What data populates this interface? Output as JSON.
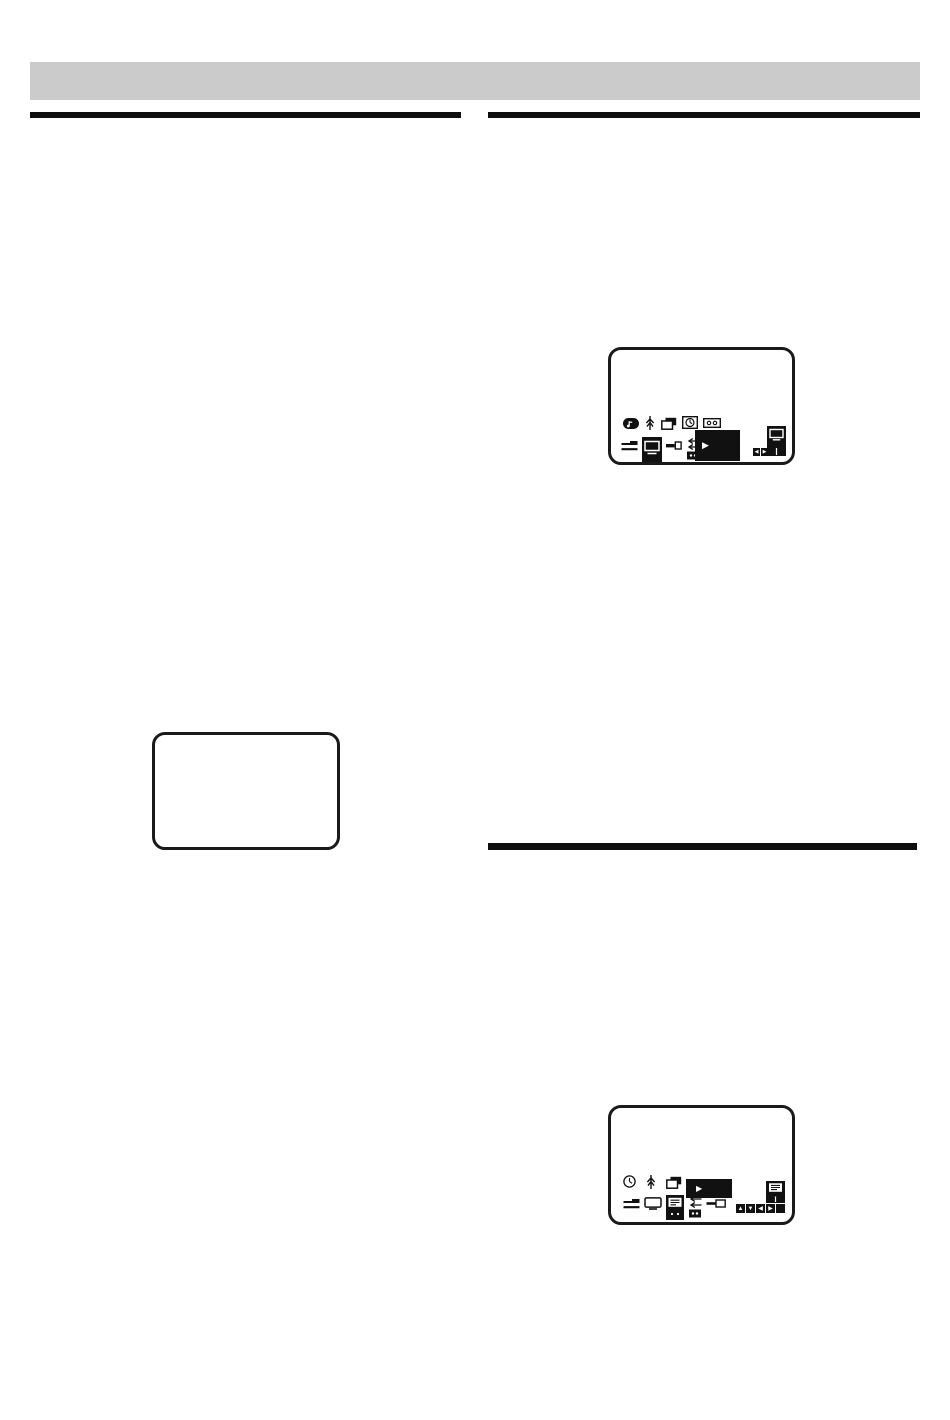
{
  "page": {
    "background_color": "#ffffff",
    "header_bar_color": "#cbcbcb",
    "rule_color": "#0e0e0e",
    "screen_border_color": "#1a1a1a",
    "menu_highlight_color": "#111111"
  },
  "glyphs": {
    "play": "▶",
    "left": "◀",
    "right": "▶",
    "up": "▲",
    "down": "▼",
    "blank": ""
  },
  "left_column": {
    "blank_screen_content": ""
  },
  "screen1": {
    "row1_icons": [
      "music-note",
      "antenna-tree",
      "page-stack",
      "clock-box",
      "cassette"
    ],
    "row2_icons": [
      "menu-lines",
      "tv-selected",
      "plug-key",
      "repeat-arrows"
    ],
    "preview_icon_glyph": "▶",
    "side_icon": "tv-tall",
    "nav": [
      "left",
      "right"
    ]
  },
  "screen2": {
    "row1_icons": [
      "clock-circle",
      "antenna-tree",
      "page-stack"
    ],
    "row2_icons": [
      "menu-lines",
      "tv-outline",
      "doc-selected",
      "repeat-arrows",
      "key-outline"
    ],
    "preview_icon_glyph": "▶",
    "side_icon": "doc-tall",
    "nav": [
      "up",
      "down",
      "left",
      "right",
      "blank"
    ]
  }
}
